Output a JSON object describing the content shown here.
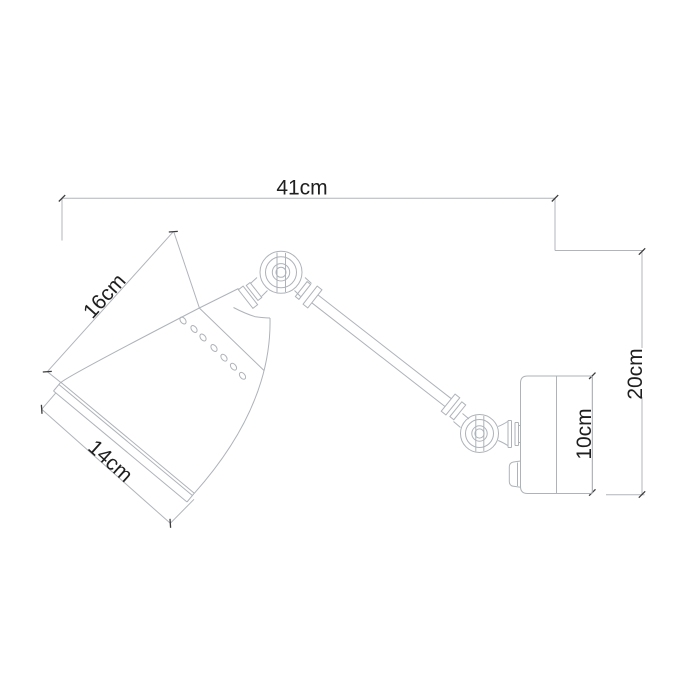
{
  "drawing": {
    "subject": "Swing-arm wall lamp technical dimension drawing, side view",
    "units": "cm",
    "labels": {
      "total_width": "41cm",
      "shade_slant_height": "16cm",
      "shade_rim_width": "14cm",
      "total_height": "20cm",
      "wall_plate_height": "10cm"
    },
    "values_cm": {
      "total_width": 41,
      "shade_slant_height": 16,
      "shade_rim_width": 14,
      "total_height": 20,
      "wall_plate_height": 10
    },
    "colors": {
      "background": "#ffffff",
      "line": "#aeb3b9",
      "tick": "#3d3d3d",
      "text": "#1f1f1f"
    }
  }
}
